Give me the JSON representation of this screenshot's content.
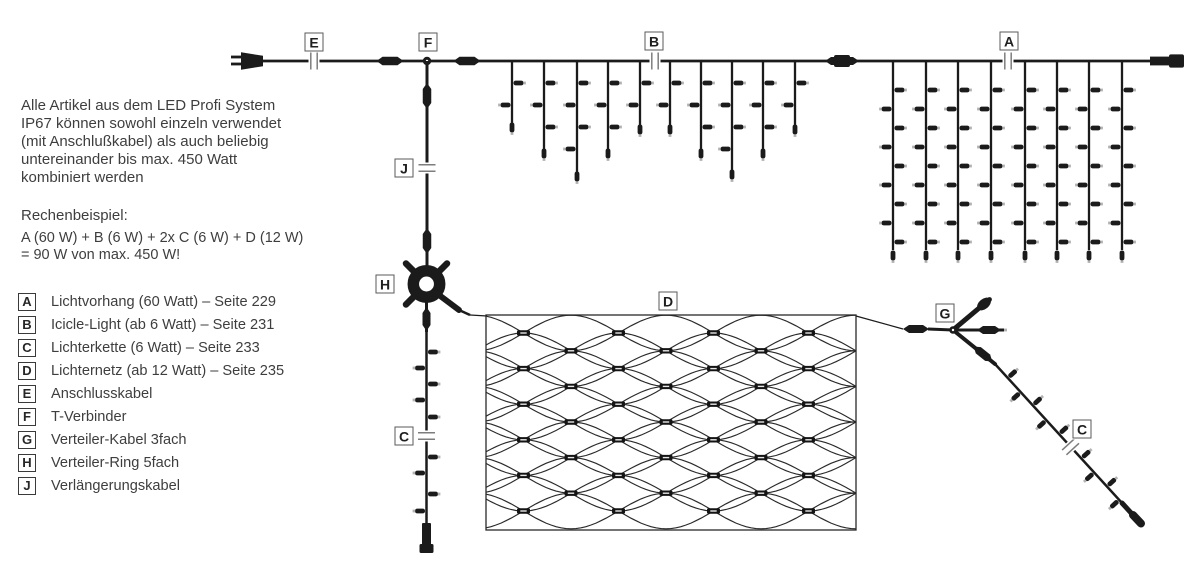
{
  "intro": {
    "lines": [
      "Alle Artikel aus dem LED Profi System",
      "IP67 können sowohl einzeln verwendet",
      "(mit Anschlußkabel) als auch beliebig",
      "untereinander bis max. 450 Watt",
      "kombiniert werden"
    ]
  },
  "example": {
    "title": "Rechenbeispiel:",
    "lines": [
      "A (60 W) + B (6 W) + 2x C (6 W) + D (12 W)",
      "= 90 W von max. 450 W!"
    ]
  },
  "legend": {
    "items": [
      {
        "key": "A",
        "label": "Lichtvorhang (60 Watt) – Seite 229"
      },
      {
        "key": "B",
        "label": "Icicle-Light (ab 6 Watt) – Seite 231"
      },
      {
        "key": "C",
        "label": "Lichterkette (6 Watt) – Seite 233"
      },
      {
        "key": "D",
        "label": "Lichternetz (ab 12 Watt) – Seite 235"
      },
      {
        "key": "E",
        "label": "Anschlusskabel"
      },
      {
        "key": "F",
        "label": "T-Verbinder"
      },
      {
        "key": "G",
        "label": "Verteiler-Kabel 3fach"
      },
      {
        "key": "H",
        "label": "Verteiler-Ring 5fach"
      },
      {
        "key": "J",
        "label": "Verlängerungskabel"
      }
    ]
  },
  "diagram": {
    "labels": {
      "a": "A",
      "b": "B",
      "c": "C",
      "c2": "C",
      "d": "D",
      "e": "E",
      "f": "F",
      "g": "G",
      "h": "H",
      "j": "J"
    },
    "icons": {
      "plug": "mains-plug-icon",
      "connector": "cable-connector-icon",
      "break": "cable-break-icon",
      "t_node": "t-connector-icon",
      "ring": "distributor-ring-icon",
      "splitter": "distributor-3way-icon",
      "bulb": "led-bulb-icon"
    }
  },
  "colors": {
    "line": "#1b1b1b",
    "net_line": "#2a2a2a",
    "text": "#3e3e3e",
    "background": "#ffffff"
  }
}
